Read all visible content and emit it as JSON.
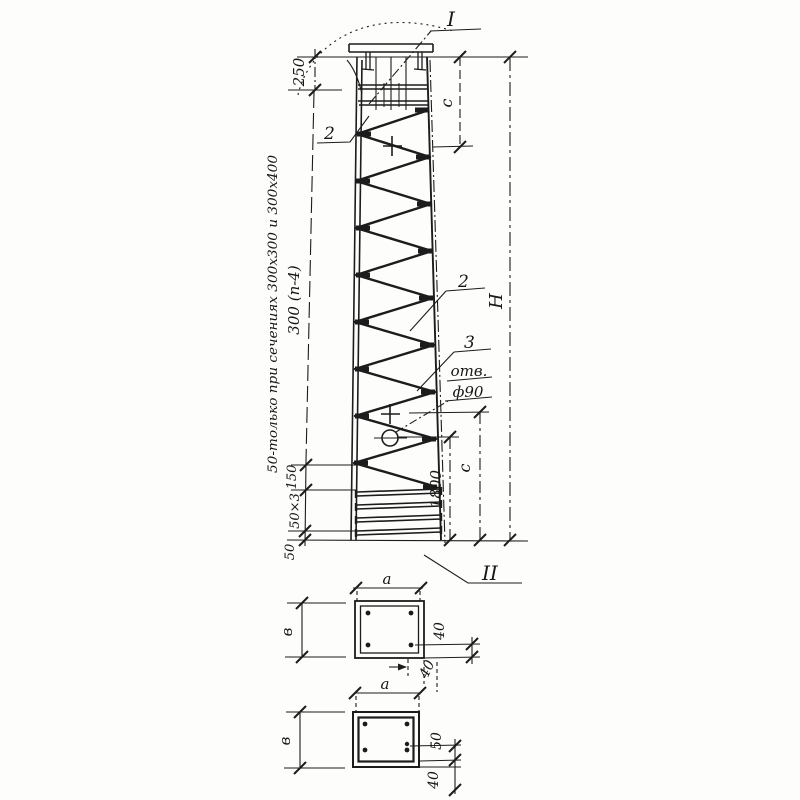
{
  "labels": {
    "mark_i": "I",
    "mark_ii": "II",
    "bar_top": "2",
    "bar_right": "2",
    "tie_right": "3",
    "hole_word": "отв.",
    "hole_dia": "ф90"
  },
  "dims": {
    "head": "250",
    "c_top": "c",
    "height": "H",
    "embed": "1800",
    "c_bottom": "c",
    "d150": "150",
    "d50x3": "50×3",
    "d50": "50"
  },
  "notes": {
    "only50": "50-только при сечениях 300х300 и 300х400",
    "pitch": "300 (п-4)"
  },
  "section_upper": {
    "a": "a",
    "b": "в",
    "cover_side": "40",
    "cover_bottom": "40"
  },
  "section_lower": {
    "a": "a",
    "b": "в",
    "gap50": "50",
    "cover40": "40"
  }
}
